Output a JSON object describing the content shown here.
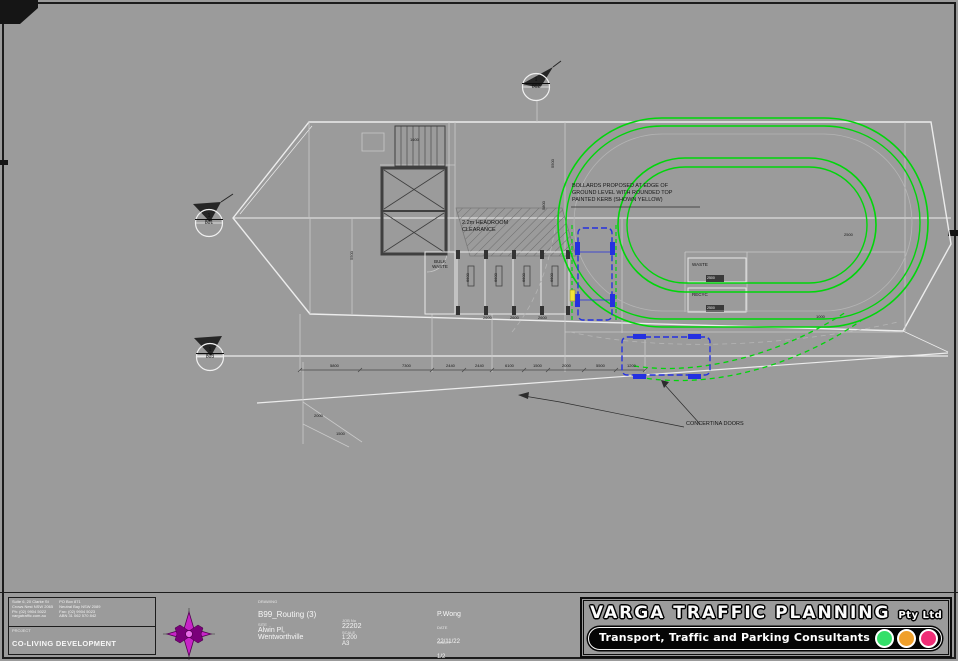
{
  "title_block": {
    "company_left": [
      "Suite 6, 20 Clarke St",
      "Crows Nest NSW 2065",
      "Ph: (02) 9904 5022",
      "vargatraffic.com.au"
    ],
    "company_right": [
      "PO Box 871",
      "Neutral Bay NSW 2089",
      "Fax: (02) 9904 5023",
      "ABN 31 062 570 842"
    ],
    "project_label": "PROJECT",
    "project_name": "CO-LIVING DEVELOPMENT",
    "drawing_label": "DRAWING",
    "drawing_title": "B99_Routing (3)",
    "site_label": "SITE",
    "site_line1": "Alwin Pl,",
    "site_line2": "Wentworthville",
    "job_label": "JOB No",
    "job_no": "22202",
    "scale_label": "SCALE",
    "scale": "1:200",
    "size": "A3",
    "drawn": "P.Wong",
    "date_label": "DATE",
    "date": "22/11/22",
    "sheet_label": "SHEET",
    "sheet_no": "1/2",
    "logo": {
      "name": "VARGA TRAFFIC PLANNING",
      "suffix": "Pty Ltd",
      "tagline": "Transport, Traffic and Parking Consultants",
      "lights": [
        "#35e06a",
        "#f0a02c",
        "#ef2d76"
      ]
    }
  },
  "notes": {
    "dock_line1": "BOLLARDS PROPOSED AT EDGE OF",
    "dock_line2": "GROUND LEVEL WITH ROUNDED TOP",
    "dock_line3": "PAINTED KERB (SHOWN YELLOW)",
    "headroom1": "2.2m HEADROOM",
    "headroom2": "CLEARANCE",
    "doors": "CONCERTINA DOORS",
    "bulk1": "BULK",
    "bulk2": "WASTE",
    "waste_room": "WASTE",
    "recycle_room": "RECYC",
    "waste_dim": "2500",
    "recycle_dim": "2500",
    "vehicle_label": "B99"
  },
  "markers": [
    {
      "num": "1",
      "ref": "801"
    },
    {
      "num": "1",
      "ref": "802"
    },
    {
      "num": "1",
      "ref": "803"
    }
  ],
  "dims": [
    {
      "x": 330,
      "y": 364,
      "v": "5800"
    },
    {
      "x": 402,
      "y": 364,
      "v": "7300"
    },
    {
      "x": 446,
      "y": 364,
      "v": "2440"
    },
    {
      "x": 475,
      "y": 364,
      "v": "2440"
    },
    {
      "x": 505,
      "y": 364,
      "v": "6100"
    },
    {
      "x": 533,
      "y": 364,
      "v": "1500"
    },
    {
      "x": 562,
      "y": 364,
      "v": "2000"
    },
    {
      "x": 596,
      "y": 364,
      "v": "5500"
    },
    {
      "x": 627,
      "y": 364,
      "v": "1200"
    },
    {
      "x": 314,
      "y": 414,
      "v": "2000"
    },
    {
      "x": 336,
      "y": 432,
      "v": "1500"
    },
    {
      "x": 410,
      "y": 138,
      "v": "1600"
    },
    {
      "x": 844,
      "y": 233,
      "v": "2500"
    },
    {
      "x": 816,
      "y": 315,
      "v": "1000"
    },
    {
      "x": 483,
      "y": 316,
      "v": "2600"
    },
    {
      "x": 510,
      "y": 316,
      "v": "2600"
    },
    {
      "x": 538,
      "y": 316,
      "v": "2600"
    },
    {
      "x": 350,
      "y": 260,
      "v": "5500",
      "rot": true
    },
    {
      "x": 551,
      "y": 168,
      "v": "5500",
      "rot": true
    },
    {
      "x": 542,
      "y": 210,
      "v": "5800",
      "rot": true
    },
    {
      "x": 466,
      "y": 282,
      "v": "6600",
      "rot": true
    },
    {
      "x": 494,
      "y": 282,
      "v": "6600",
      "rot": true
    },
    {
      "x": 522,
      "y": 282,
      "v": "6600",
      "rot": true
    },
    {
      "x": 550,
      "y": 282,
      "v": "6600",
      "rot": true
    }
  ],
  "colors": {
    "swept_path": "#00d60a",
    "vehicle": "#2430e0",
    "compass": "#c724c7",
    "highlight_yellow": "#f2e23a"
  }
}
